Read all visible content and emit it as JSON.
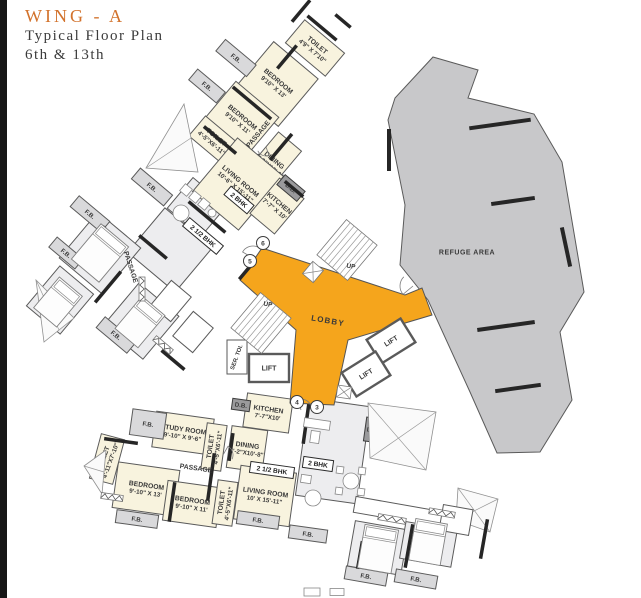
{
  "header": {
    "wing": "WING - A",
    "line1": "Typical Floor Plan",
    "line2": "6th & 13th"
  },
  "colors": {
    "cream": "#F8F3DE",
    "gray": "#EDEDEF",
    "balcony": "#D9D9DB",
    "white": "#FFFFFF",
    "dark": "#9A9A9C",
    "lobby": "#F5A51C",
    "refuge": "#C8C8CA",
    "wall": "#262626",
    "line": "#5A5A5A",
    "text": "#3A3A3A",
    "accent": "#D2722C"
  },
  "lobby": {
    "points": [
      [
        262,
        248
      ],
      [
        405,
        295
      ],
      [
        422,
        288
      ],
      [
        432,
        315
      ],
      [
        348,
        340
      ],
      [
        334,
        405
      ],
      [
        290,
        403
      ],
      [
        296,
        330
      ],
      [
        240,
        280
      ]
    ]
  },
  "refuge": {
    "points": [
      [
        433,
        57
      ],
      [
        478,
        70
      ],
      [
        468,
        98
      ],
      [
        534,
        114
      ],
      [
        562,
        162
      ],
      [
        584,
        292
      ],
      [
        560,
        332
      ],
      [
        572,
        400
      ],
      [
        540,
        452
      ],
      [
        497,
        453
      ],
      [
        470,
        392
      ],
      [
        428,
        300
      ],
      [
        400,
        265
      ],
      [
        405,
        205
      ],
      [
        388,
        120
      ],
      [
        395,
        98
      ]
    ]
  },
  "rooms": [
    {
      "f": "gray",
      "x": 170,
      "y": 250,
      "w": 62,
      "h": 58,
      "r": 40
    },
    {
      "f": "gray",
      "x": 197,
      "y": 207,
      "w": 44,
      "h": 40,
      "r": 40
    },
    {
      "f": "gray",
      "x": 100,
      "y": 253,
      "w": 56,
      "h": 60,
      "r": 40
    },
    {
      "f": "gray",
      "x": 141,
      "y": 321,
      "w": 52,
      "h": 56,
      "r": 40
    },
    {
      "f": "gray",
      "x": 60,
      "y": 300,
      "w": 44,
      "h": 52,
      "r": 40
    },
    {
      "f": "white",
      "x": 171,
      "y": 301,
      "w": 26,
      "h": 32,
      "r": 40
    },
    {
      "f": "white",
      "x": 193,
      "y": 332,
      "w": 26,
      "h": 32,
      "r": 40
    },
    {
      "f": "gray",
      "x": 333,
      "y": 451,
      "w": 62,
      "h": 98,
      "r": 8
    },
    {
      "f": "gray",
      "x": 378,
      "y": 548,
      "w": 54,
      "h": 46,
      "r": 10
    },
    {
      "f": "gray",
      "x": 429,
      "y": 541,
      "w": 52,
      "h": 44,
      "r": 10
    },
    {
      "f": "white",
      "x": 398,
      "y": 512,
      "w": 88,
      "h": 16,
      "r": 10
    },
    {
      "f": "white",
      "x": 456,
      "y": 520,
      "w": 30,
      "h": 26,
      "r": 10
    },
    {
      "n": "TOILET",
      "d": "4'9\" X 7'10\"",
      "f": "cream",
      "x": 315,
      "y": 48,
      "w": 52,
      "h": 30,
      "r": 40
    },
    {
      "n": "BEDROOM",
      "d": "9'10\" X 13'",
      "f": "cream",
      "x": 276,
      "y": 84,
      "w": 58,
      "h": 62,
      "r": 40
    },
    {
      "n": "BEDROOM",
      "d": "9'10\" X 11'",
      "f": "cream",
      "x": 240,
      "y": 120,
      "w": 56,
      "h": 54,
      "r": 40
    },
    {
      "n": "TOILET",
      "d": "4'-5\"X6'-11\"",
      "f": "cream",
      "x": 214,
      "y": 140,
      "w": 44,
      "h": 26,
      "r": 40
    },
    {
      "n": "DINING",
      "d": "5'-2\"X10'-6\"",
      "f": "cream",
      "x": 272,
      "y": 163,
      "w": 30,
      "h": 56,
      "r": 40
    },
    {
      "n": "LIVING ROOM",
      "d": "10'-6\" X 15'-11\"",
      "f": "cream",
      "x": 238,
      "y": 184,
      "w": 60,
      "h": 70,
      "r": 40
    },
    {
      "n": "KITCHEN",
      "d": "7'-7\" X 10'",
      "f": "cream",
      "x": 277,
      "y": 206,
      "w": 32,
      "h": 46,
      "r": 40
    },
    {
      "n": "STUDY ROOM",
      "d": "9'-10\" X 9'-6\"",
      "f": "cream",
      "x": 183,
      "y": 433,
      "w": 58,
      "h": 36,
      "r": 8
    },
    {
      "n": "KITCHEN",
      "d": "7'-7\"X10'",
      "f": "cream",
      "x": 268,
      "y": 413,
      "w": 46,
      "h": 34,
      "r": 8
    },
    {
      "n": "DINING",
      "d": "5'-2\"X10'-8\"",
      "f": "cream",
      "x": 247,
      "y": 449,
      "w": 36,
      "h": 42,
      "r": 8
    },
    {
      "n": "BEDROOM",
      "d": "9'-10\" X 13'",
      "f": "cream",
      "x": 146,
      "y": 489,
      "w": 62,
      "h": 46,
      "r": 8
    },
    {
      "n": "BEDROOM",
      "d": "9'-10\" X 11'",
      "f": "cream",
      "x": 192,
      "y": 504,
      "w": 54,
      "h": 40,
      "r": 8
    },
    {
      "n": "LIVING ROOM",
      "d": "10' X 15'-11\"",
      "f": "cream",
      "x": 265,
      "y": 496,
      "w": 56,
      "h": 54,
      "r": 8
    },
    {
      "n": "TOILET",
      "d": "4'-5\"X6'-11\"",
      "f": "cream",
      "x": 214,
      "y": 447,
      "w": 20,
      "h": 46,
      "r": 8,
      "tr": -82
    },
    {
      "n": "TOILET",
      "d": "4'-5\"X6'-11\"",
      "f": "cream",
      "x": 225,
      "y": 503,
      "w": 20,
      "h": 44,
      "r": 8,
      "tr": -82
    },
    {
      "n": "TOILET",
      "d": "4'-11\"X7'-10\"",
      "f": "cream",
      "x": 107,
      "y": 459,
      "w": 24,
      "h": 46,
      "r": 15,
      "tr": -70
    },
    {
      "n": "F.B.",
      "f": "balcony",
      "x": 236,
      "y": 58,
      "w": 40,
      "h": 15,
      "r": 40
    },
    {
      "n": "F.B.",
      "f": "balcony",
      "x": 207,
      "y": 86,
      "w": 36,
      "h": 14,
      "r": 40
    },
    {
      "n": "F.B.",
      "f": "balcony",
      "x": 152,
      "y": 187,
      "w": 42,
      "h": 14,
      "r": 40
    },
    {
      "n": "F.B.",
      "f": "balcony",
      "x": 90,
      "y": 214,
      "w": 40,
      "h": 14,
      "r": 40
    },
    {
      "n": "F.B.",
      "f": "balcony",
      "x": 66,
      "y": 253,
      "w": 34,
      "h": 13,
      "r": 40
    },
    {
      "n": "F.B.",
      "f": "balcony",
      "x": 116,
      "y": 335,
      "w": 40,
      "h": 14,
      "r": 40
    },
    {
      "n": "F.B.",
      "f": "balcony",
      "x": 148,
      "y": 424,
      "w": 34,
      "h": 26,
      "r": 8
    },
    {
      "n": "F.B.",
      "f": "balcony",
      "x": 137,
      "y": 519,
      "w": 42,
      "h": 13,
      "r": 8
    },
    {
      "n": "F.B.",
      "f": "balcony",
      "x": 258,
      "y": 520,
      "w": 42,
      "h": 13,
      "r": 8
    },
    {
      "n": "F.B.",
      "f": "balcony",
      "x": 308,
      "y": 534,
      "w": 38,
      "h": 13,
      "r": 8
    },
    {
      "n": "F.B.",
      "f": "balcony",
      "x": 366,
      "y": 576,
      "w": 42,
      "h": 13,
      "r": 10
    },
    {
      "n": "F.B.",
      "f": "balcony",
      "x": 416,
      "y": 579,
      "w": 42,
      "h": 13,
      "r": 10
    },
    {
      "n": "D.B.",
      "f": "dark",
      "x": 291,
      "y": 188,
      "w": 26,
      "h": 13,
      "r": 40
    },
    {
      "n": "D.B.",
      "f": "dark",
      "x": 241,
      "y": 405,
      "w": 18,
      "h": 11,
      "r": 8
    },
    {
      "n": "D.B.",
      "f": "dark",
      "x": 373,
      "y": 430,
      "w": 16,
      "h": 24,
      "r": 8
    },
    {
      "n": "LIFT",
      "f": "white",
      "x": 269,
      "y": 368,
      "w": 40,
      "h": 28,
      "r": 0,
      "k": 1
    },
    {
      "n": "LIFT",
      "f": "white",
      "x": 391,
      "y": 341,
      "w": 40,
      "h": 28,
      "r": -32,
      "k": 1
    },
    {
      "n": "LIFT",
      "f": "white",
      "x": 366,
      "y": 374,
      "w": 40,
      "h": 28,
      "r": -32,
      "k": 1
    },
    {
      "f": "white",
      "x": 237,
      "y": 357,
      "w": 20,
      "h": 34,
      "r": 0
    }
  ],
  "texts": [
    {
      "t": "PASSAGE",
      "x": 258,
      "y": 134,
      "r": -50,
      "s": 6.8
    },
    {
      "t": "PASSAGE",
      "x": 131,
      "y": 267,
      "r": 72,
      "s": 6.8
    },
    {
      "t": "PASSAGE",
      "x": 196,
      "y": 468,
      "r": 8,
      "s": 6.8
    },
    {
      "t": "UP",
      "x": 351,
      "y": 266,
      "r": 10,
      "s": 6.5
    },
    {
      "t": "UP",
      "x": 268,
      "y": 304,
      "r": 10,
      "s": 6.5
    },
    {
      "t": "LOBBY",
      "x": 328,
      "y": 321,
      "r": 10,
      "s": 8,
      "ls": 1.2
    },
    {
      "t": "REFUGE AREA",
      "x": 467,
      "y": 252,
      "r": 0,
      "s": 7,
      "ls": 0.5
    },
    {
      "t": "SER. TOI.",
      "x": 236,
      "y": 357,
      "r": -70,
      "s": 5.8
    }
  ],
  "badges": [
    {
      "t": "2 BHK",
      "x": 239,
      "y": 200,
      "r": 40,
      "w": 30
    },
    {
      "t": "2 1/2 BHK",
      "x": 203,
      "y": 236,
      "r": 40,
      "w": 44
    },
    {
      "t": "2 1/2 BHK",
      "x": 272,
      "y": 470,
      "r": 8,
      "w": 44
    },
    {
      "t": "2 BHK",
      "x": 318,
      "y": 464,
      "r": 8,
      "w": 30
    }
  ],
  "circles": [
    {
      "t": "6",
      "x": 263,
      "y": 243
    },
    {
      "t": "5",
      "x": 250,
      "y": 261
    },
    {
      "t": "4",
      "x": 297,
      "y": 402
    },
    {
      "t": "3",
      "x": 317,
      "y": 407
    }
  ],
  "walls": [
    [
      322,
      28,
      38,
      40
    ],
    [
      287,
      57,
      30,
      -50
    ],
    [
      252,
      103,
      50,
      40
    ],
    [
      220,
      140,
      42,
      40
    ],
    [
      281,
      147,
      34,
      -50
    ],
    [
      294,
      189,
      24,
      40
    ],
    [
      207,
      217,
      48,
      40
    ],
    [
      153,
      247,
      36,
      40
    ],
    [
      108,
      287,
      40,
      -50
    ],
    [
      173,
      360,
      30,
      40
    ],
    [
      96,
      237,
      28,
      -50
    ],
    [
      211,
      477,
      48,
      98
    ],
    [
      231,
      447,
      28,
      98
    ],
    [
      172,
      502,
      40,
      98
    ],
    [
      121,
      441,
      34,
      8
    ],
    [
      306,
      424,
      40,
      98
    ],
    [
      360,
      555,
      28,
      100
    ],
    [
      409,
      546,
      44,
      100
    ],
    [
      484,
      539,
      40,
      100
    ],
    [
      500,
      124,
      62,
      -8,
      4
    ],
    [
      513,
      201,
      44,
      -8,
      4
    ],
    [
      506,
      326,
      58,
      -8,
      4
    ],
    [
      518,
      388,
      46,
      -8,
      4
    ],
    [
      389,
      150,
      42,
      90,
      4
    ],
    [
      566,
      247,
      40,
      78,
      4
    ],
    [
      301,
      11,
      28,
      -50
    ],
    [
      343,
      21,
      20,
      40
    ],
    [
      247,
      270,
      24,
      -50
    ]
  ],
  "stairs": [
    {
      "x": 347,
      "y": 250,
      "w": 46,
      "h": 40,
      "r": -50,
      "n": 7
    },
    {
      "x": 261,
      "y": 323,
      "w": 46,
      "h": 40,
      "r": -50,
      "n": 7
    }
  ],
  "shafts": [
    [
      313,
      272,
      16,
      14,
      -50
    ],
    [
      344,
      392,
      14,
      12,
      8
    ]
  ],
  "hatches": [
    [
      [
        146,
        168
      ],
      [
        184,
        104
      ],
      [
        198,
        172
      ]
    ],
    [
      [
        36,
        280
      ],
      [
        74,
        318
      ],
      [
        44,
        342
      ]
    ],
    [
      [
        84,
        466
      ],
      [
        106,
        450
      ],
      [
        102,
        494
      ]
    ],
    [
      [
        368,
        403
      ],
      [
        436,
        412
      ],
      [
        426,
        470
      ],
      [
        370,
        458
      ]
    ],
    [
      [
        458,
        488
      ],
      [
        498,
        499
      ],
      [
        490,
        532
      ],
      [
        456,
        520
      ]
    ],
    [
      [
        414,
        176
      ],
      [
        446,
        184
      ],
      [
        440,
        208
      ],
      [
        410,
        200
      ]
    ]
  ],
  "arcs": [
    [
      253,
      258,
      12,
      210
    ],
    [
      413,
      286,
      13,
      140
    ],
    [
      301,
      410,
      11,
      255
    ],
    [
      223,
      455,
      10,
      300
    ],
    [
      266,
      147,
      9,
      70
    ]
  ],
  "beds": [
    [
      100,
      253,
      36,
      46,
      40
    ],
    [
      140,
      322,
      30,
      42,
      40
    ],
    [
      58,
      302,
      30,
      40,
      40
    ],
    [
      378,
      549,
      34,
      44,
      10
    ],
    [
      428,
      542,
      32,
      42,
      10
    ]
  ],
  "wardrobes": [
    [
      142,
      289,
      24,
      90
    ],
    [
      112,
      497,
      22,
      8
    ],
    [
      392,
      519,
      28,
      10
    ],
    [
      442,
      513,
      26,
      10
    ],
    [
      163,
      345,
      22,
      40
    ]
  ],
  "deco_rects": [
    [
      186,
      190,
      9,
      9,
      40
    ],
    [
      195,
      197,
      9,
      9,
      40
    ],
    [
      204,
      204,
      9,
      9,
      40
    ],
    [
      317,
      424,
      26,
      9,
      8
    ],
    [
      315,
      437,
      9,
      12,
      8
    ],
    [
      340,
      470,
      7,
      7,
      8
    ],
    [
      362,
      471,
      7,
      7,
      8
    ],
    [
      339,
      491,
      7,
      7,
      8
    ],
    [
      361,
      492,
      7,
      7,
      8
    ],
    [
      306,
      479,
      10,
      8,
      8
    ],
    [
      312,
      592,
      16,
      8,
      0
    ],
    [
      337,
      592,
      14,
      7,
      0
    ]
  ],
  "deco_circles": [
    [
      181,
      213,
      8
    ],
    [
      212,
      213,
      4
    ],
    [
      351,
      481,
      8
    ],
    [
      313,
      498,
      8
    ]
  ]
}
